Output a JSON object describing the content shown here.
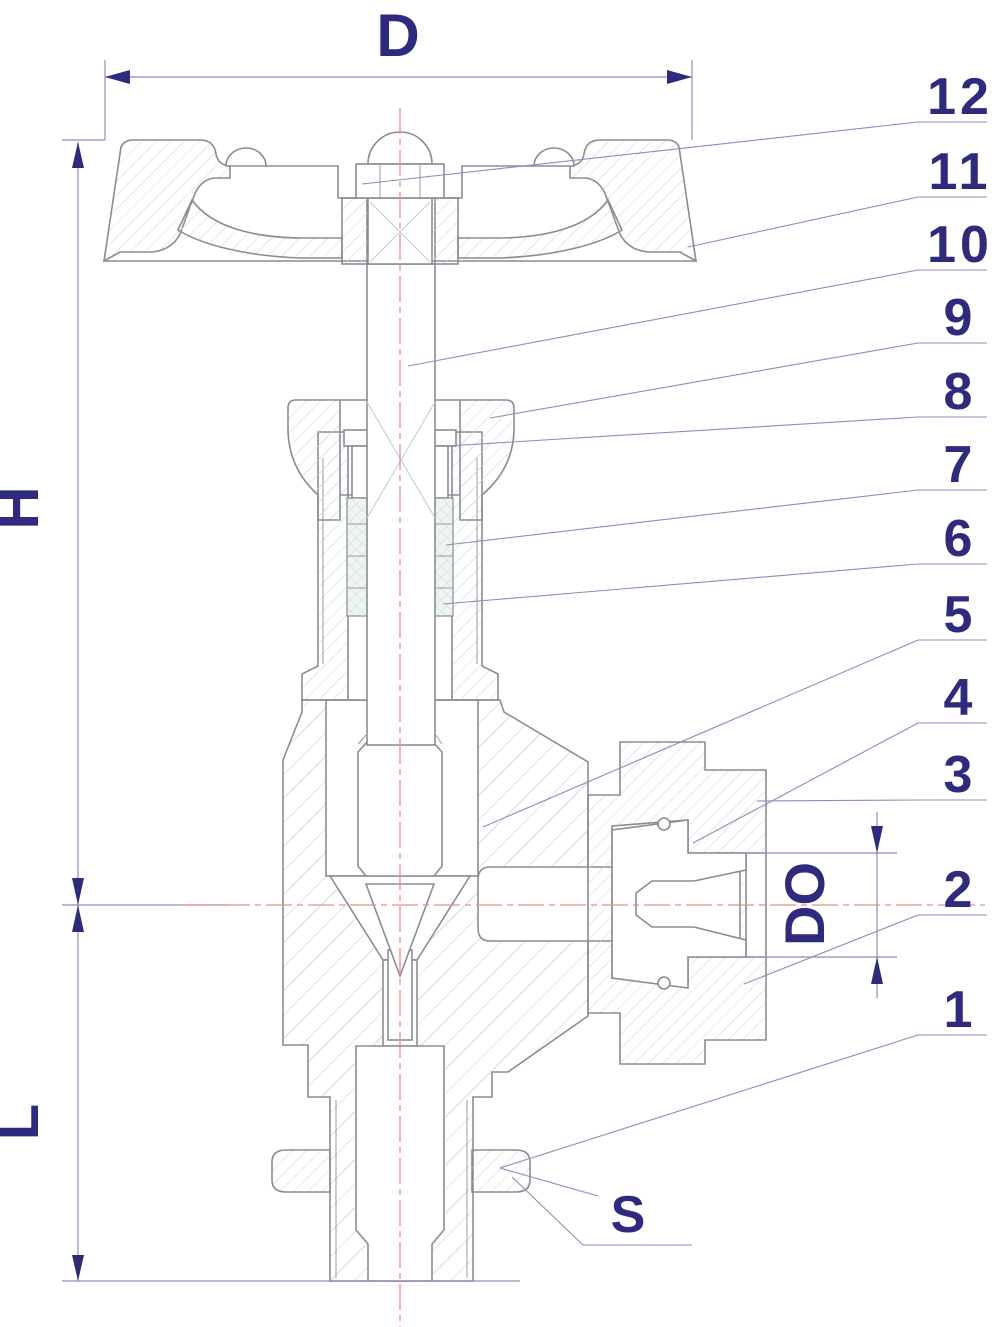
{
  "dimension_labels": {
    "diameter": "D",
    "upper_height": "H",
    "lower_height": "L",
    "outlet_bore": "DO",
    "wrench_size": "S"
  },
  "callouts": [
    {
      "label": "12"
    },
    {
      "label": "11"
    },
    {
      "label": "10"
    },
    {
      "label": "9"
    },
    {
      "label": "8"
    },
    {
      "label": "7"
    },
    {
      "label": "6"
    },
    {
      "label": "5"
    },
    {
      "label": "4"
    },
    {
      "label": "3"
    },
    {
      "label": "2"
    },
    {
      "label": "1"
    }
  ],
  "colors": {
    "outline": "#8b8b95",
    "dimension_text": "#2e2a7d",
    "leader_line": "#8f8dbb",
    "centerline": "#ee8d88",
    "hatch_teal": "#cde1db",
    "hatch_blue": "#c9d0e6",
    "background": "#ffffff"
  }
}
